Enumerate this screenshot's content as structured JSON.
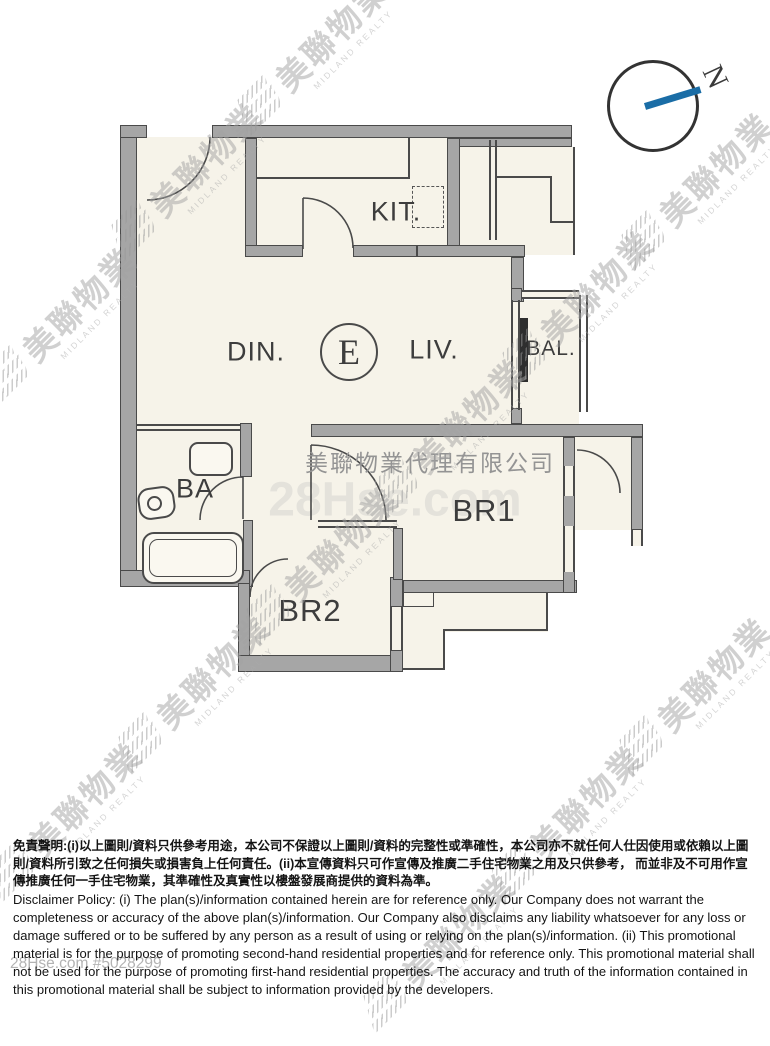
{
  "compass": {
    "north_label": "N",
    "needle_color": "#1a6da6"
  },
  "floorplan": {
    "unit_label": "E",
    "rooms": {
      "kitchen": "KIT.",
      "dining": "DIN.",
      "living": "LIV.",
      "balcony": "BAL.",
      "bathroom": "BA",
      "bedroom1": "BR1",
      "bedroom2": "BR2"
    },
    "colors": {
      "floor": "#f6f3e9",
      "wall_fill": "#a6a6a6",
      "wall_edge": "#4a4a4a",
      "balcony_door": "#2e2e2e"
    }
  },
  "watermarks": {
    "brand_cn": "美聯物業",
    "brand_en": "MIDLAND REALTY",
    "agency_name": "美聯物業代理有限公司",
    "portal_center": "28Hse.com",
    "listing_ref": "28Hse.com #5028299"
  },
  "disclaimer": {
    "chinese": "免責聲明:(i)以上圖則/資料只供參考用途，本公司不保證以上圖則/資料的完整性或準確性，本公司亦不就任何人仕因使用或依賴以上圖則/資料所引致之任何損失或損害負上任何責任。(ii)本宣傳資料只可作宣傳及推廣二手住宅物業之用及只供參考， 而並非及不可用作宣傳推廣任何一手住宅物業，其準確性及真實性以樓盤發展商提供的資料為準。",
    "english": "Disclaimer Policy: (i) The plan(s)/information contained herein are for reference only. Our Company does not warrant the completeness or accuracy of the above plan(s)/information. Our Company also disclaims any liability whatsoever for any loss or damage suffered or to be suffered by any person as a result of using or relying on the plan(s)/information. (ii) This promotional material is for the purpose of promoting second-hand residential properties and for reference only. This promotional material shall not be used for the purpose of promoting first-hand residential properties. The accuracy and truth of the information contained in this promotional material shall be subject to information provided by the developers."
  }
}
